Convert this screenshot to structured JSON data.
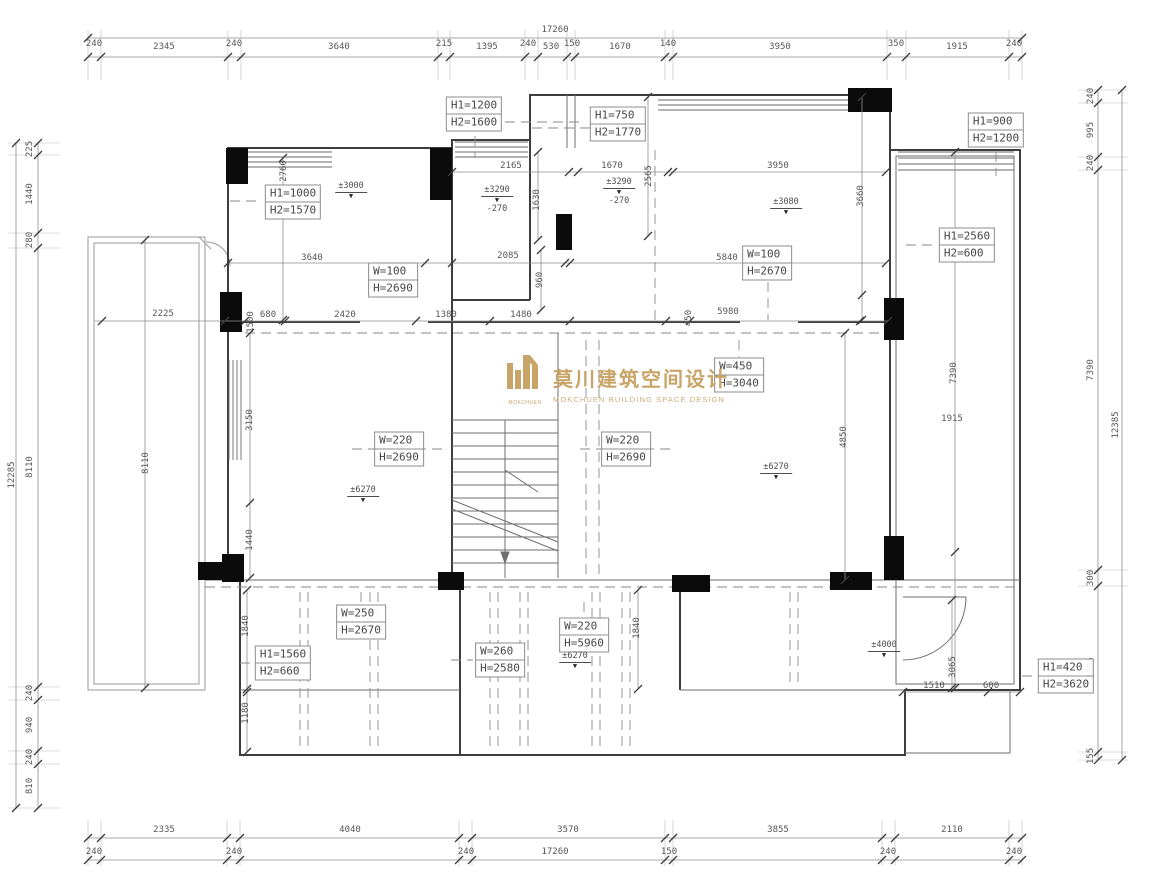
{
  "logo": {
    "cn": "莫川建筑空间设计",
    "en": "MOKCHUEN BUILDING SPACE DESIGN",
    "mark": "MOKCHUEN",
    "color": "#C8A468"
  },
  "chains": {
    "top": {
      "overall": "17260",
      "segments": [
        "240",
        "2345",
        "240",
        "3640",
        "215",
        "1395",
        "240",
        "530",
        "150",
        "1670",
        "140",
        "3950",
        "350",
        "1915",
        "240"
      ]
    },
    "bottom": {
      "overall": "17260",
      "segments": [
        "240",
        "2335",
        "240",
        "4040",
        "240",
        "3570",
        "150",
        "3855",
        "240",
        "2110",
        "240"
      ]
    },
    "left": {
      "overall": "12285",
      "segments": [
        "225",
        "1440",
        "280",
        "8110",
        "240",
        "940",
        "240",
        "810"
      ]
    },
    "right": {
      "overall": "12385",
      "segments": [
        "240",
        "995",
        "240",
        "7390",
        "300",
        "3065",
        "155"
      ]
    }
  },
  "dim_texts": [
    {
      "t": "2165",
      "x": 511,
      "y": 166
    },
    {
      "t": "1670",
      "x": 612,
      "y": 166
    },
    {
      "t": "3950",
      "x": 778,
      "y": 166
    },
    {
      "t": "2760",
      "x": 284,
      "y": 171,
      "r": -90
    },
    {
      "t": "1630",
      "x": 537,
      "y": 200,
      "r": -90
    },
    {
      "t": "2565",
      "x": 649,
      "y": 176,
      "r": -90
    },
    {
      "t": "3660",
      "x": 861,
      "y": 196,
      "r": -90
    },
    {
      "t": "3640",
      "x": 312,
      "y": 258
    },
    {
      "t": "2085",
      "x": 508,
      "y": 256
    },
    {
      "t": "5840",
      "x": 727,
      "y": 258
    },
    {
      "t": "960",
      "x": 540,
      "y": 280,
      "r": -90
    },
    {
      "t": "2225",
      "x": 163,
      "y": 314
    },
    {
      "t": "1500",
      "x": 251,
      "y": 322,
      "r": -90
    },
    {
      "t": "680",
      "x": 268,
      "y": 315
    },
    {
      "t": "2420",
      "x": 345,
      "y": 315
    },
    {
      "t": "1380",
      "x": 446,
      "y": 315
    },
    {
      "t": "1480",
      "x": 521,
      "y": 315
    },
    {
      "t": "450",
      "x": 689,
      "y": 318,
      "r": -90
    },
    {
      "t": "5980",
      "x": 728,
      "y": 312
    },
    {
      "t": "3150",
      "x": 250,
      "y": 420,
      "r": -90
    },
    {
      "t": "8110",
      "x": 146,
      "y": 463,
      "r": -90
    },
    {
      "t": "1440",
      "x": 250,
      "y": 540,
      "r": -90
    },
    {
      "t": "7390",
      "x": 954,
      "y": 373,
      "r": -90
    },
    {
      "t": "1915",
      "x": 952,
      "y": 419
    },
    {
      "t": "4850",
      "x": 844,
      "y": 437,
      "r": -90
    },
    {
      "t": "1840",
      "x": 246,
      "y": 626,
      "r": -90
    },
    {
      "t": "1840",
      "x": 637,
      "y": 628,
      "r": -90
    },
    {
      "t": "1180",
      "x": 246,
      "y": 713,
      "r": -90
    },
    {
      "t": "3065",
      "x": 953,
      "y": 667,
      "r": -90
    },
    {
      "t": "1510",
      "x": 934,
      "y": 686
    },
    {
      "t": "600",
      "x": 991,
      "y": 686
    }
  ],
  "opening_labels": [
    {
      "l1": "H1=1200",
      "l2": "H2=1600",
      "x": 474,
      "y": 114
    },
    {
      "l1": "H1=750",
      "l2": "H2=1770",
      "x": 618,
      "y": 124
    },
    {
      "l1": "H1=900",
      "l2": "H2=1200",
      "x": 996,
      "y": 130
    },
    {
      "l1": "H1=1000",
      "l2": "H2=1570",
      "x": 293,
      "y": 202
    },
    {
      "l1": "H1=2560",
      "l2": "H2=600",
      "x": 967,
      "y": 245
    },
    {
      "l1": "W=100",
      "l2": "H=2690",
      "x": 393,
      "y": 280
    },
    {
      "l1": "W=100",
      "l2": "H=2670",
      "x": 767,
      "y": 263
    },
    {
      "l1": "W=450",
      "l2": "H=3040",
      "x": 739,
      "y": 375
    },
    {
      "l1": "W=220",
      "l2": "H=2690",
      "x": 399,
      "y": 449
    },
    {
      "l1": "W=220",
      "l2": "H=2690",
      "x": 626,
      "y": 449
    },
    {
      "l1": "W=250",
      "l2": "H=2670",
      "x": 361,
      "y": 622
    },
    {
      "l1": "W=220",
      "l2": "H=5960",
      "x": 584,
      "y": 635
    },
    {
      "l1": "W=260",
      "l2": "H=2580",
      "x": 500,
      "y": 660
    },
    {
      "l1": "H1=1560",
      "l2": "H2=660",
      "x": 283,
      "y": 663
    },
    {
      "l1": "H1=420",
      "l2": "H2=3620",
      "x": 1066,
      "y": 676
    }
  ],
  "elevation_marks": [
    {
      "t": "±3000",
      "x": 351,
      "y": 182
    },
    {
      "t": "±3290",
      "sub": "-270",
      "x": 497,
      "y": 186
    },
    {
      "t": "±3290",
      "sub": "-270",
      "x": 619,
      "y": 178
    },
    {
      "t": "±3080",
      "x": 786,
      "y": 198
    },
    {
      "t": "±6270",
      "x": 363,
      "y": 486
    },
    {
      "t": "±6270",
      "x": 776,
      "y": 463
    },
    {
      "t": "±6270",
      "x": 575,
      "y": 652
    },
    {
      "t": "±4000",
      "x": 884,
      "y": 641
    }
  ]
}
